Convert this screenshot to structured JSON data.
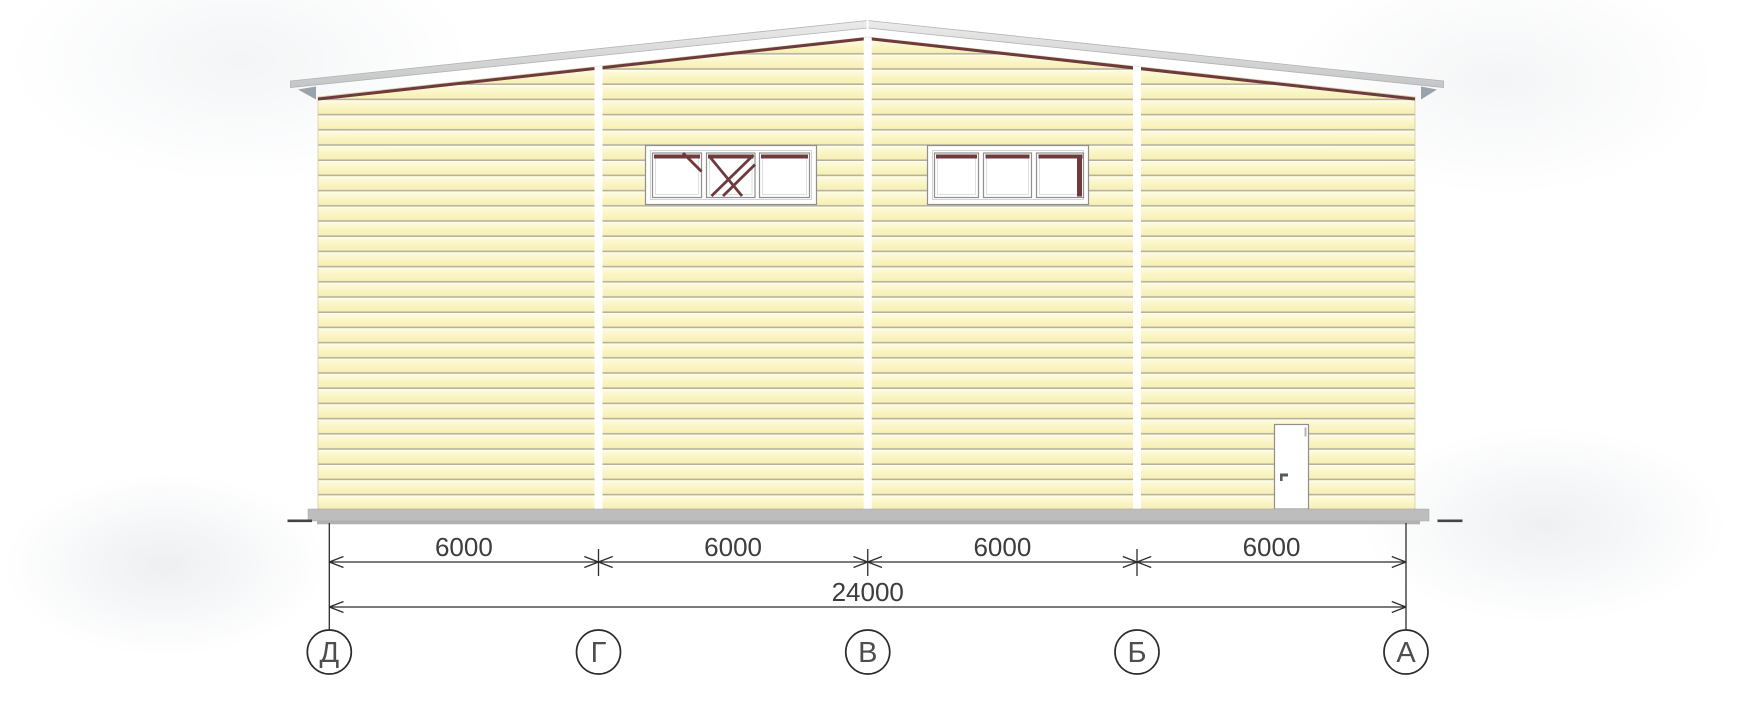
{
  "drawing": {
    "type": "building-facade-elevation",
    "axes": {
      "labels": [
        "Д",
        "Г",
        "В",
        "Б",
        "А"
      ]
    },
    "dimensions": {
      "bays": [
        "6000",
        "6000",
        "6000",
        "6000"
      ],
      "total": "24000"
    },
    "colors": {
      "wall_light": "#fdfada",
      "wall_deep": "#f7efb2",
      "siding_line": "#b5b19b",
      "trim": "#6e3a3c",
      "roof": "#c9cacb",
      "roof_edge": "#b3b3b3",
      "eave_cap": "#9aa2ab",
      "foundation": "#bdbdbd",
      "ink": "#2c2c2c",
      "text": "#3d3d3d"
    }
  }
}
